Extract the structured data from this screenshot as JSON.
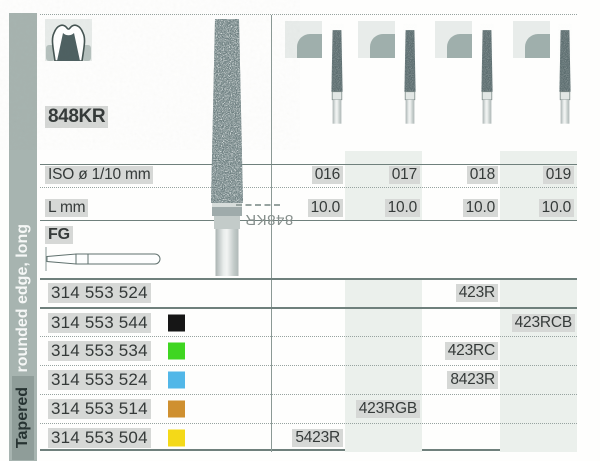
{
  "sidebar": {
    "category_label": "Tapered",
    "shape_label": "rounded edge, long"
  },
  "header": {
    "figure_code": "848KR",
    "bur_watermark": "848KR",
    "tooth_icon": "prepared-molar-icon",
    "tip_shape_icon": "rounded-edge-taper-icon"
  },
  "spec_rows": {
    "iso_label": "ISO ø 1/10 mm",
    "iso_values": [
      "016",
      "017",
      "018",
      "019"
    ],
    "length_label": "L mm",
    "length_values": [
      "10.0",
      "10.0",
      "10.0",
      "10.0"
    ],
    "shank_label": "FG"
  },
  "products": [
    {
      "order_no": "314 553 524",
      "grit": "none",
      "grit_color": "",
      "code": "423R",
      "iso_column": "018"
    },
    {
      "order_no": "314 553 544",
      "grit": "black",
      "grit_color": "#161616",
      "code": "423RCB",
      "iso_column": "019"
    },
    {
      "order_no": "314 553 534",
      "grit": "green",
      "grit_color": "#3fd621",
      "code": "423RC",
      "iso_column": "018"
    },
    {
      "order_no": "314 553 524",
      "grit": "blue",
      "grit_color": "#52b7e8",
      "code": "8423R",
      "iso_column": "018"
    },
    {
      "order_no": "314 553 514",
      "grit": "orange",
      "grit_color": "#cf9030",
      "code": "423RGB",
      "iso_column": "017"
    },
    {
      "order_no": "314 553 504",
      "grit": "yellow",
      "grit_color": "#f4d918",
      "code": "5423R",
      "iso_column": "016"
    }
  ],
  "theme": {
    "sidebar_bar": "#a7b4b0",
    "sidebar_box": "#8f9d99",
    "column_tint": "#ebf0ec",
    "line_strong": "#6f807c",
    "bur_dark": "#5b6c6e",
    "highlight": "#d6d8d6"
  }
}
